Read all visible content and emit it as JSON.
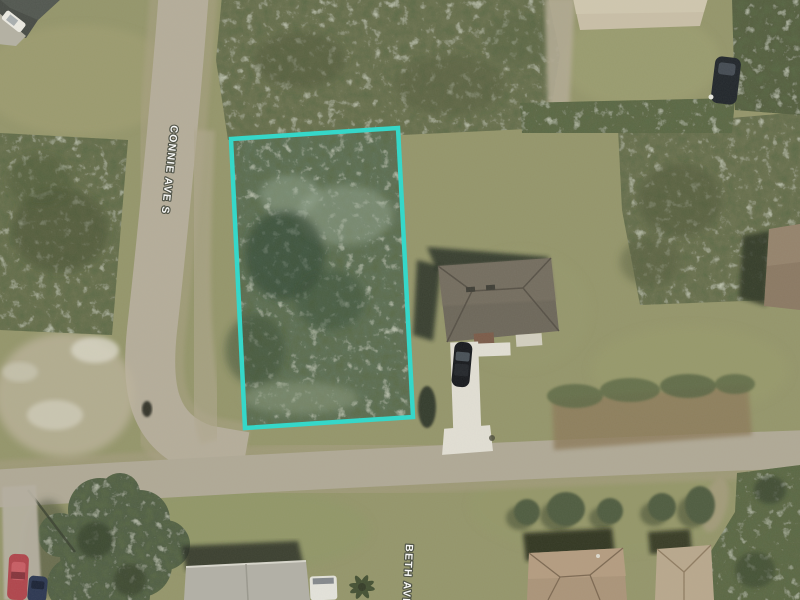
{
  "image": {
    "kind": "aerial-parcel-photo",
    "street_labels": [
      {
        "text": "CONNIE AVE S"
      },
      {
        "text": "BETH AVE S"
      }
    ],
    "parcel_outline_color": "#2fd9cb",
    "colors": {
      "grass": "#95966b",
      "scrub_vegetation": "#6b7150",
      "road": "#b2ab97",
      "dirt_shoulder": "#8d7a5a",
      "driveway_concrete": "#e2dfd4",
      "main_roof": "#6d675a",
      "tan_roof": "#ab9479"
    }
  }
}
